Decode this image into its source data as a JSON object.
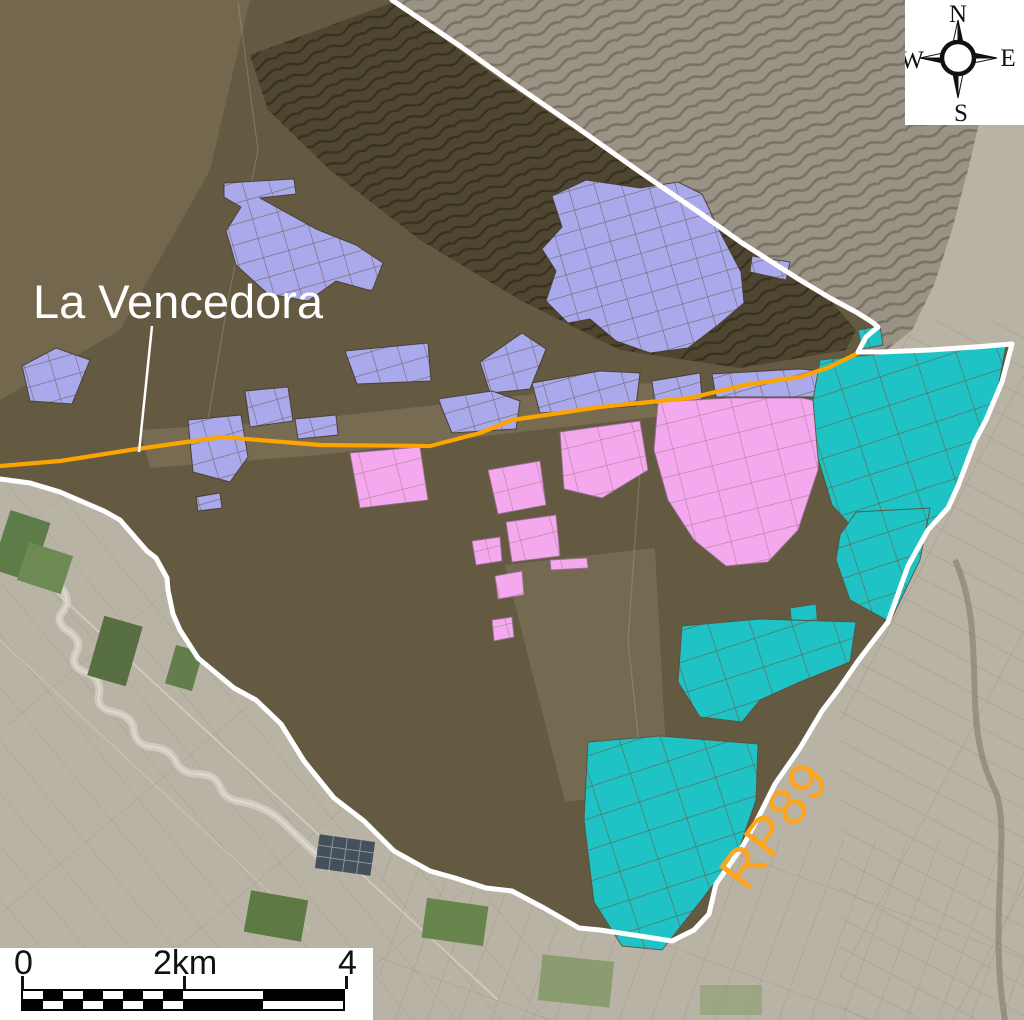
{
  "map": {
    "region_label": "La Vencedora",
    "road_label": "RP89",
    "overlay_colors": {
      "parcels_lavender": "#A9A9EC",
      "parcels_pink": "#F4A9EF",
      "parcels_cyan": "#1FC3C6",
      "road": "#FCA400",
      "boundary": "#FFFFFF"
    }
  },
  "compass": {
    "north": "N",
    "east": "E",
    "south": "S",
    "west": "W"
  },
  "scale_bar": {
    "start_label": "0",
    "mid_label": "2km",
    "end_label": "4"
  }
}
